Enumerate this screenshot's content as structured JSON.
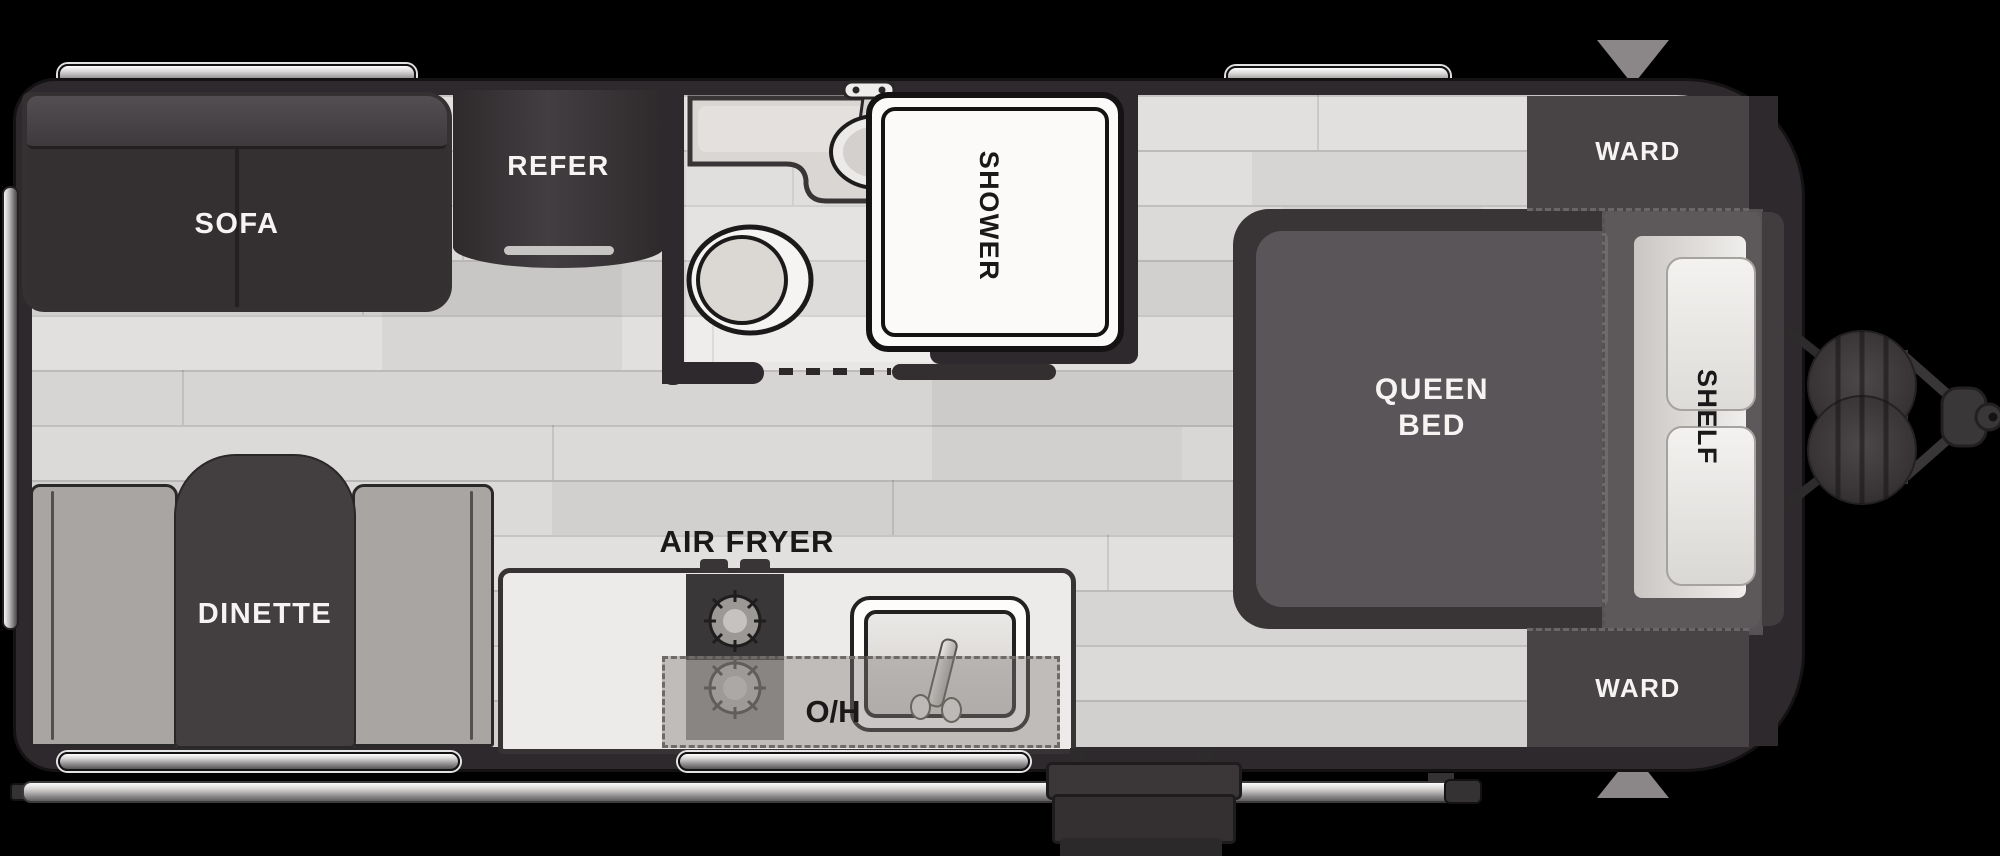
{
  "title": "Travel Trailer Floorplan",
  "labels": {
    "sofa": "SOFA",
    "refrigerator": "REFER",
    "shower": "SHOWER",
    "wardrobe_front_top": "WARD",
    "wardrobe_front_bottom": "WARD",
    "queen_bed_line1": "QUEEN",
    "queen_bed_line2": "BED",
    "shelf": "SHELF",
    "dinette": "DINETTE",
    "air_fryer": "AIR FRYER",
    "overhead_cabinet": "O/H"
  },
  "colors": {
    "background": "#000000",
    "wall": "#2d292c",
    "floor_light": "#e2e0de",
    "floor_dark": "#d4d2d0",
    "furniture_dark": "#3a3638",
    "bench_gray": "#a8a5a2",
    "mattress_gray": "#5a5558",
    "label_light": "#f5f4f3",
    "label_dark": "#1a1818",
    "fixture_white": "#fbfaf9",
    "metal_silver": "#c9c8c7",
    "arrow_gray": "#8b8789"
  }
}
